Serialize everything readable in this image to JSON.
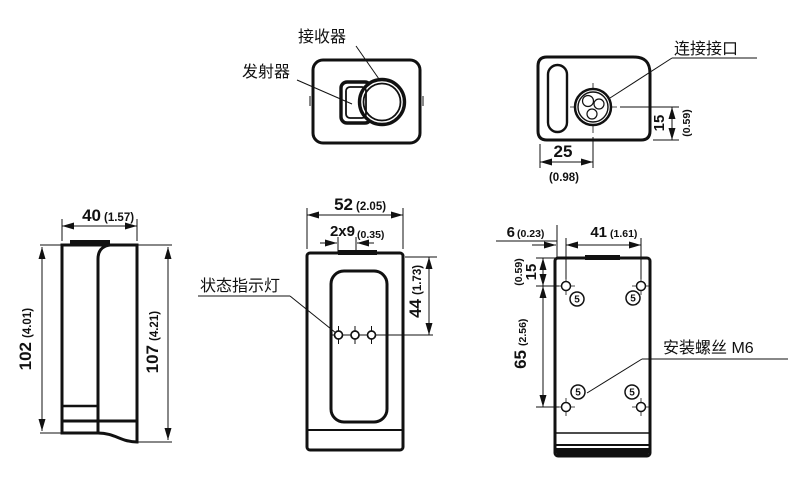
{
  "drawing": {
    "labels": {
      "receiver": "接收器",
      "transmitter": "发射器",
      "connector": "连接接口",
      "status_led": "状态指示灯",
      "mounting_screw": "安装螺丝 M6",
      "screw_mark": "5"
    },
    "dims": {
      "top_width": "25",
      "top_width_in": "(0.98)",
      "top_height": "15",
      "top_height_in": "(0.59)",
      "left_depth": "40",
      "left_depth_in": "(1.57)",
      "left_body": "102",
      "left_body_in": "(4.01)",
      "left_total": "107",
      "left_total_in": "(4.21)",
      "front_width": "52",
      "front_width_in": "(2.05)",
      "front_slot": "2x9",
      "front_slot_in": "(0.35)",
      "front_window": "44",
      "front_window_in": "(1.73)",
      "back_edge": "6",
      "back_edge_in": "(0.23)",
      "back_width": "41",
      "back_width_in": "(1.61)",
      "back_top": "15",
      "back_top_in": "(0.59)",
      "back_height": "65",
      "back_height_in": "(2.56)"
    }
  }
}
